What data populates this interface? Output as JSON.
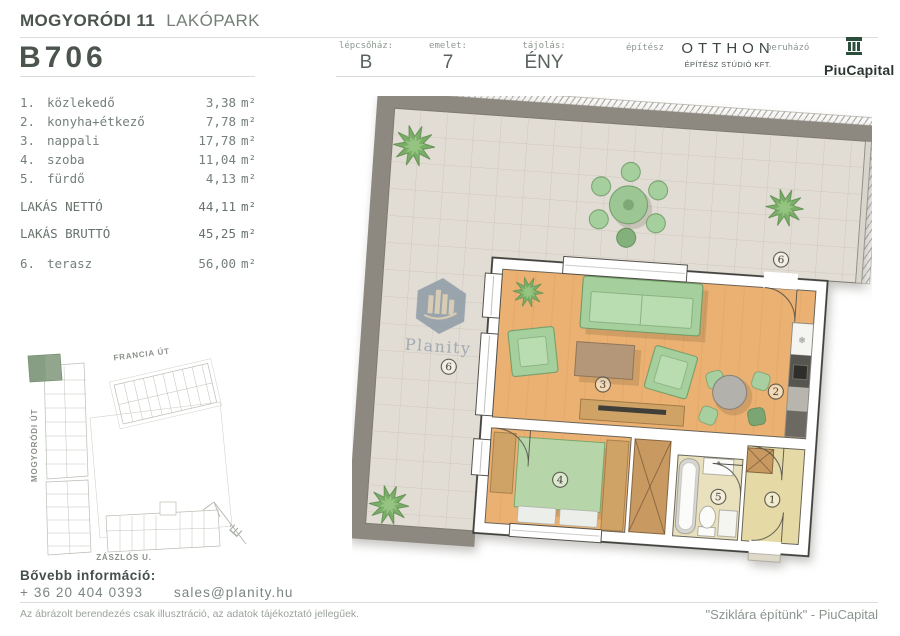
{
  "header": {
    "project_bold": "MOGYORÓDI 11",
    "project_light": "LAKÓPARK",
    "unit_id": "B706",
    "stair_label": "lépcsőház:",
    "stair_value": "B",
    "floor_label": "emelet:",
    "floor_value": "7",
    "orient_label": "tájolás:",
    "orient_value": "ÉNY",
    "architect_label": "építész",
    "architect_name": "OTTHON",
    "architect_sub": "ÉPÍTÉSZ STÚDIÓ KFT.",
    "developer_label": "beruházó",
    "developer_name": "PiuCapital"
  },
  "units": {
    "m2": "m²"
  },
  "rooms": [
    {
      "no": "1.",
      "name": "közlekedő",
      "area": "3,38"
    },
    {
      "no": "2.",
      "name": "konyha+étkező",
      "area": "7,78"
    },
    {
      "no": "3.",
      "name": "nappali",
      "area": "17,78"
    },
    {
      "no": "4.",
      "name": "szoba",
      "area": "11,04"
    },
    {
      "no": "5.",
      "name": "fürdő",
      "area": "4,13"
    }
  ],
  "totals": [
    {
      "name": "LAKÁS NETTÓ",
      "area": "44,11"
    },
    {
      "name": "LAKÁS BRUTTÓ",
      "area": "45,25"
    }
  ],
  "terrace_row": {
    "no": "6.",
    "name": "terasz",
    "area": "56,00"
  },
  "sitemap": {
    "street_top": "FRANCIA ÚT",
    "street_left": "MOGYORÓDI ÚT",
    "street_bottom": "ZÁSZLÓS U.",
    "compass": "É"
  },
  "plan": {
    "labels": {
      "hall": "1",
      "kitchen": "2",
      "living": "3",
      "bedroom": "4",
      "bath": "5",
      "terrace": "6"
    },
    "fridge_glyph": "❄"
  },
  "watermark": {
    "text": "Planity"
  },
  "contact": {
    "heading": "Bővebb információ:",
    "phone": "+ 36 20 404 0393",
    "email": "sales@planity.hu"
  },
  "footer": {
    "disclaimer": "Az ábrázolt berendezés csak illusztráció, az adatok tájékoztató jellegűek.",
    "tagline": "\"Sziklára építünk\" - PiuCapital"
  },
  "colors": {
    "brand_dark": "#4b544d",
    "text_muted": "#75807a",
    "highlight_green": "#92a68e",
    "logo_green": "#2c4f3c",
    "wood_floor": "#ebb172",
    "terrace_tile": "#e2ddd4",
    "furniture_green": "#a5cf9d"
  }
}
